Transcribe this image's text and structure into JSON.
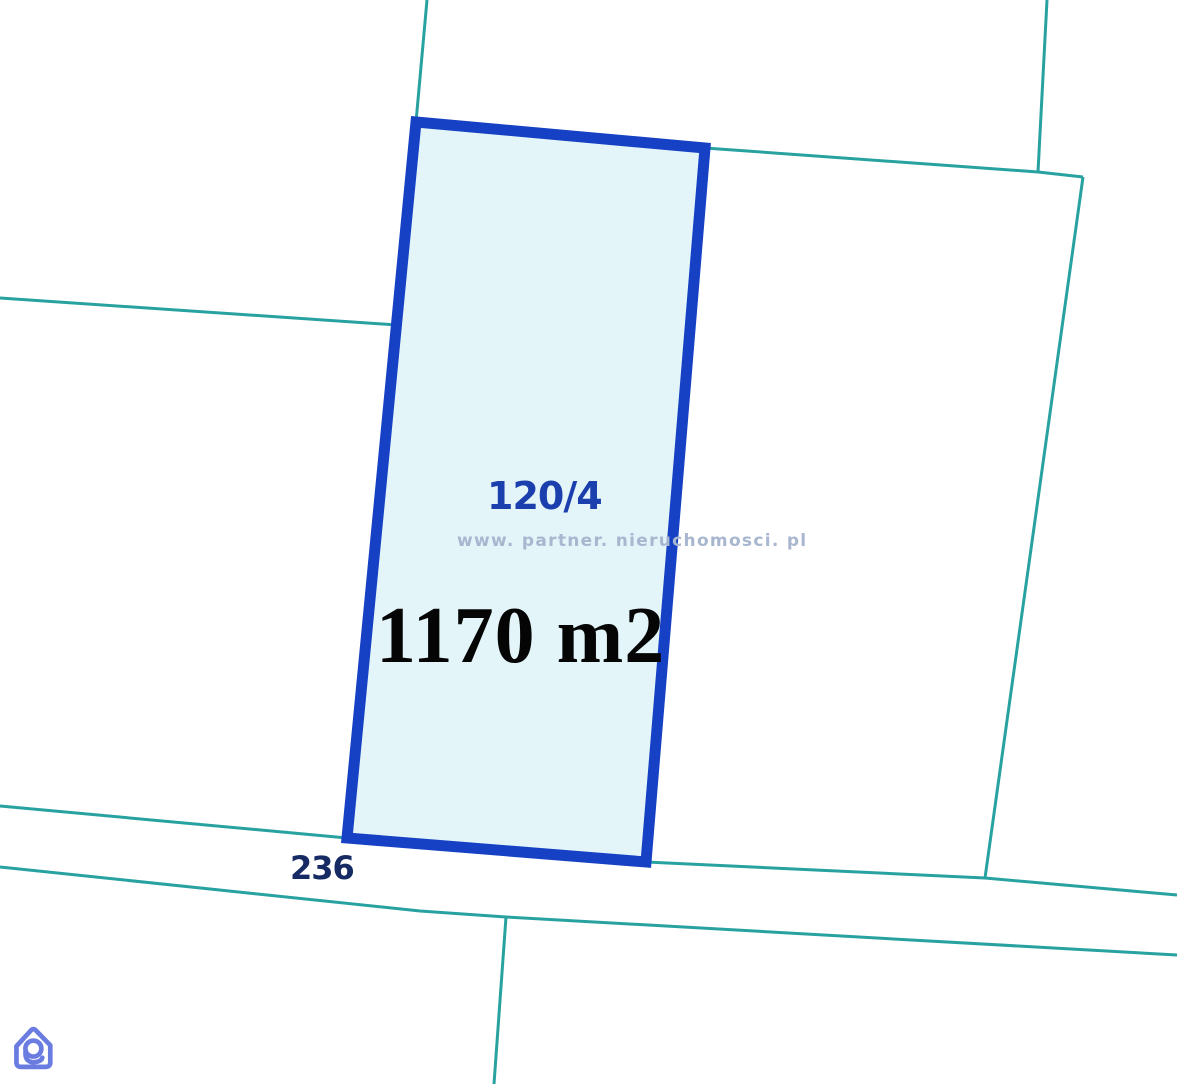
{
  "map": {
    "labels": {
      "parcel_number": "120/4",
      "area": "1170 m2",
      "road_number": "236",
      "watermark": "www. partner. nieruchomosci. pl"
    },
    "colors": {
      "background": "#ffffff",
      "boundary_line": "#28a2a0",
      "parcel_border": "#1641c4",
      "parcel_fill": "#e3f5f9",
      "parcel_number_text": "#1c3fae",
      "area_text": "#050505",
      "road_number_text": "#162a63",
      "watermark_text": "#a9b6cf"
    },
    "geometry": {
      "parcel_polygon": [
        [
          416,
          122
        ],
        [
          705,
          148
        ],
        [
          646,
          862
        ],
        [
          347,
          838
        ]
      ],
      "parcel_border_width": 11,
      "boundary_line_width": 3,
      "lines": [
        [
          [
            427,
            0
          ],
          [
            416,
            122
          ]
        ],
        [
          [
            0,
            298
          ],
          [
            397,
            325
          ]
        ],
        [
          [
            705,
            148
          ],
          [
            1038,
            172
          ],
          [
            1083,
            177
          ]
        ],
        [
          [
            1047,
            0
          ],
          [
            1038,
            172
          ]
        ],
        [
          [
            1083,
            177
          ],
          [
            985,
            878
          ]
        ],
        [
          [
            0,
            806
          ],
          [
            347,
            838
          ]
        ],
        [
          [
            646,
            862
          ],
          [
            985,
            878
          ],
          [
            1177,
            895
          ]
        ],
        [
          [
            0,
            867
          ],
          [
            420,
            911
          ],
          [
            506,
            917
          ],
          [
            1177,
            955
          ]
        ],
        [
          [
            506,
            917
          ],
          [
            494,
            1084
          ]
        ]
      ]
    }
  },
  "logo": {
    "name": "partner-nieruchomosci-logo",
    "color": "#6b7ce1"
  }
}
